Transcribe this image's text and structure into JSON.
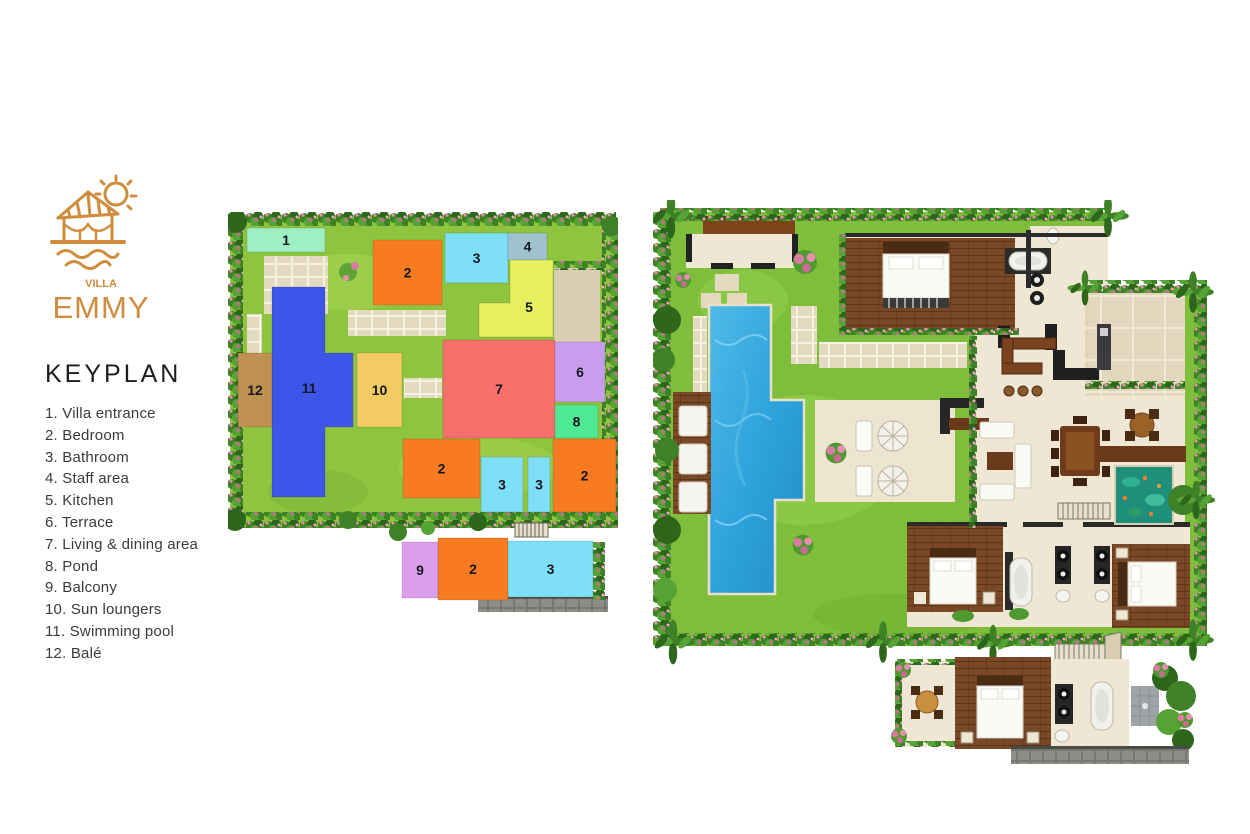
{
  "brand": {
    "villa_label": "VILLA",
    "name": "EMMY"
  },
  "title": "KEYPLAN",
  "legend": [
    {
      "num": "1.",
      "label": "Villa entrance"
    },
    {
      "num": "2.",
      "label": "Bedroom"
    },
    {
      "num": "3.",
      "label": "Bathroom"
    },
    {
      "num": "4.",
      "label": "Staff area"
    },
    {
      "num": "5.",
      "label": "Kitchen"
    },
    {
      "num": "6.",
      "label": "Terrace"
    },
    {
      "num": "7.",
      "label": "Living & dining area"
    },
    {
      "num": "8.",
      "label": "Pond"
    },
    {
      "num": "9.",
      "label": "Balcony"
    },
    {
      "num": "10.",
      "label": "Sun loungers"
    },
    {
      "num": "11.",
      "label": "Swimming pool"
    },
    {
      "num": "12.",
      "label": "Balé"
    }
  ],
  "colors": {
    "accent": "#CE8C3C",
    "number_text": "#15191f",
    "lawn": "#8FC43F",
    "lawn_light": "#A8D755",
    "hedge_green": "#3F8126",
    "flower_pink": "#D87CA0",
    "paver": "#E4DAC0",
    "floor": "#EFE7D3",
    "wood": "#7A4826",
    "pool_blue": "#2FA3DC",
    "pond_teal": "#1F8F7C",
    "stone_gray": "#8E8E88"
  },
  "keyplan_blocks": [
    {
      "n": "1",
      "color": "#9FEFC4",
      "x": 19,
      "y": 16,
      "w": 78,
      "h": 24
    },
    {
      "n": "2",
      "color": "#F87B21",
      "x": 145,
      "y": 28,
      "w": 69,
      "h": 65
    },
    {
      "n": "3",
      "color": "#7EDFF8",
      "x": 217,
      "y": 21,
      "w": 63,
      "h": 50
    },
    {
      "n": "4",
      "color": "#9FC3CE",
      "x": 280,
      "y": 21,
      "w": 39,
      "h": 27
    },
    {
      "n": "5",
      "color": "#E6EF5F",
      "d": "M282 48 L325 48 L325 125 L251 125 L251 91 L282 91 Z",
      "lx": 301,
      "ly": 95
    },
    {
      "n": "7",
      "color": "#F96F6B",
      "x": 215,
      "y": 128,
      "w": 112,
      "h": 98
    },
    {
      "n": "6",
      "color": "#C89DEE",
      "x": 327,
      "y": 130,
      "w": 50,
      "h": 60
    },
    {
      "n": "8",
      "color": "#50E993",
      "x": 327,
      "y": 193,
      "w": 43,
      "h": 33
    },
    {
      "n": "2",
      "color": "#F87B21",
      "x": 175,
      "y": 227,
      "w": 77,
      "h": 59
    },
    {
      "n": "3",
      "color": "#7EDFF8",
      "x": 253,
      "y": 245,
      "w": 42,
      "h": 55
    },
    {
      "n": "3",
      "color": "#7EDFF8",
      "x": 300,
      "y": 245,
      "w": 22,
      "h": 55
    },
    {
      "n": "2",
      "color": "#F87B21",
      "x": 325,
      "y": 227,
      "w": 63,
      "h": 73
    },
    {
      "n": "11",
      "color": "#3D55E8",
      "d": "M44 75 L97 75 L97 141 L125 141 L125 215 L97 215 L97 285 L44 285 Z",
      "lx": 81,
      "ly": 176
    },
    {
      "n": "10",
      "color": "#F2CB64",
      "x": 129,
      "y": 141,
      "w": 45,
      "h": 74
    },
    {
      "n": "12",
      "color": "#BE9150",
      "x": 10,
      "y": 141,
      "w": 34,
      "h": 74
    },
    {
      "n": "9",
      "color": "#DC9FEC",
      "x": 174,
      "y": 330,
      "w": 36,
      "h": 56
    },
    {
      "n": "2",
      "color": "#F87B21",
      "x": 210,
      "y": 326,
      "w": 70,
      "h": 62
    },
    {
      "n": "3",
      "color": "#7EDFF8",
      "x": 280,
      "y": 329,
      "w": 85,
      "h": 56
    }
  ]
}
